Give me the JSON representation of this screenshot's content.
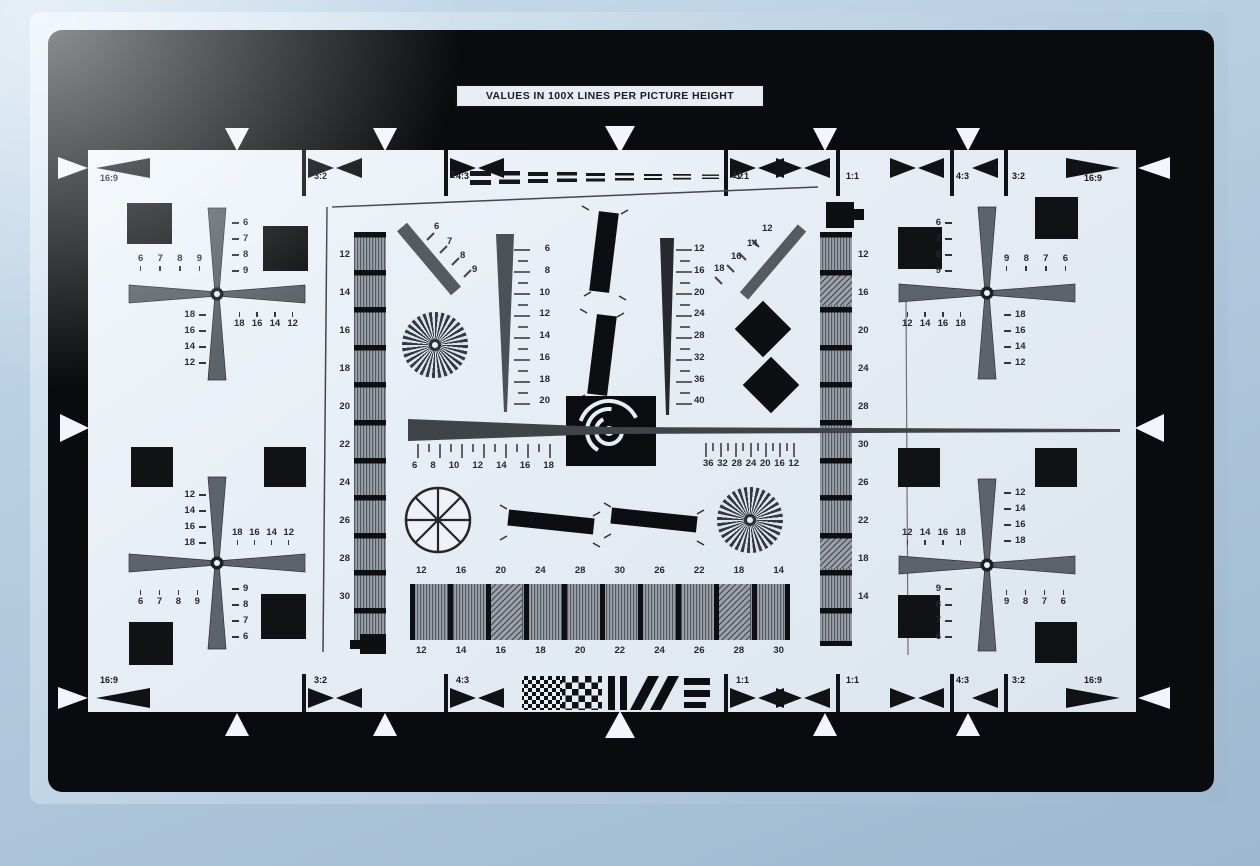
{
  "title": "VALUES IN 100X LINES PER PICTURE HEIGHT",
  "aspect_markers": {
    "top_left": [
      "16:9",
      "3:2",
      "4:3",
      "1:1"
    ],
    "top_right": [
      "1:1",
      "4:3",
      "3:2",
      "16:9"
    ],
    "bottom_left": [
      "16:9",
      "3:2",
      "4:3",
      "1:1"
    ],
    "bottom_right": [
      "1:1",
      "4:3",
      "3:2",
      "16:9"
    ]
  },
  "top_wedge": {
    "start": "1",
    "end": "10"
  },
  "columns": {
    "left": [
      "12",
      "14",
      "16",
      "18",
      "20",
      "22",
      "24",
      "26",
      "28",
      "30"
    ],
    "right": [
      "12",
      "16",
      "20",
      "24",
      "28",
      "30",
      "26",
      "22",
      "18",
      "14"
    ]
  },
  "center": {
    "left_scale": [
      "6",
      "8",
      "10",
      "12",
      "14",
      "16",
      "18",
      "20"
    ],
    "right_scale": [
      "12",
      "16",
      "20",
      "24",
      "28",
      "32",
      "36",
      "40"
    ],
    "diag_left": [
      "6",
      "7",
      "8",
      "9"
    ],
    "diag_right": [
      "12",
      "14",
      "16",
      "18"
    ],
    "sweep_left": [
      "6",
      "8",
      "10",
      "12",
      "14",
      "16",
      "18"
    ],
    "sweep_right": [
      "36",
      "32",
      "28",
      "24",
      "20",
      "16",
      "12"
    ]
  },
  "bottom_bars": {
    "top_labels": [
      "12",
      "16",
      "20",
      "24",
      "28",
      "30",
      "26",
      "22",
      "18",
      "14"
    ],
    "bottom_labels": [
      "12",
      "14",
      "16",
      "18",
      "20",
      "22",
      "24",
      "26",
      "28",
      "30"
    ]
  },
  "fans": {
    "top_left": {
      "top_row": [
        "6",
        "7",
        "8",
        "9"
      ],
      "right_col": [
        "6",
        "7",
        "8",
        "9"
      ],
      "left_col": [
        "18",
        "16",
        "14",
        "12"
      ],
      "bottom_row": [
        "18",
        "16",
        "14",
        "12"
      ]
    },
    "top_right": {
      "top_row": [
        "9",
        "8",
        "7",
        "6"
      ],
      "left_col": [
        "6",
        "7",
        "8",
        "9"
      ],
      "right_col": [
        "18",
        "16",
        "14",
        "12"
      ],
      "bottom_row": [
        "12",
        "14",
        "16",
        "18"
      ]
    },
    "bottom_left": {
      "top_col": [
        "12",
        "14",
        "16",
        "18"
      ],
      "top_row": [
        "18",
        "16",
        "14",
        "12"
      ],
      "bottom_row": [
        "6",
        "7",
        "8",
        "9"
      ],
      "right_col": [
        "9",
        "8",
        "7",
        "6"
      ]
    },
    "bottom_right": {
      "top_col": [
        "12",
        "14",
        "16",
        "18"
      ],
      "top_row": [
        "12",
        "14",
        "16",
        "18"
      ],
      "bottom_row": [
        "9",
        "8",
        "7",
        "6"
      ],
      "left_col": [
        "9",
        "8",
        "7",
        "6"
      ]
    }
  },
  "colors": {
    "background": "#b3cbdf",
    "frame": "#0a0b0e",
    "field": "#e7edf4",
    "ink": "#252a32",
    "gray_wedge": "#5d636b"
  }
}
